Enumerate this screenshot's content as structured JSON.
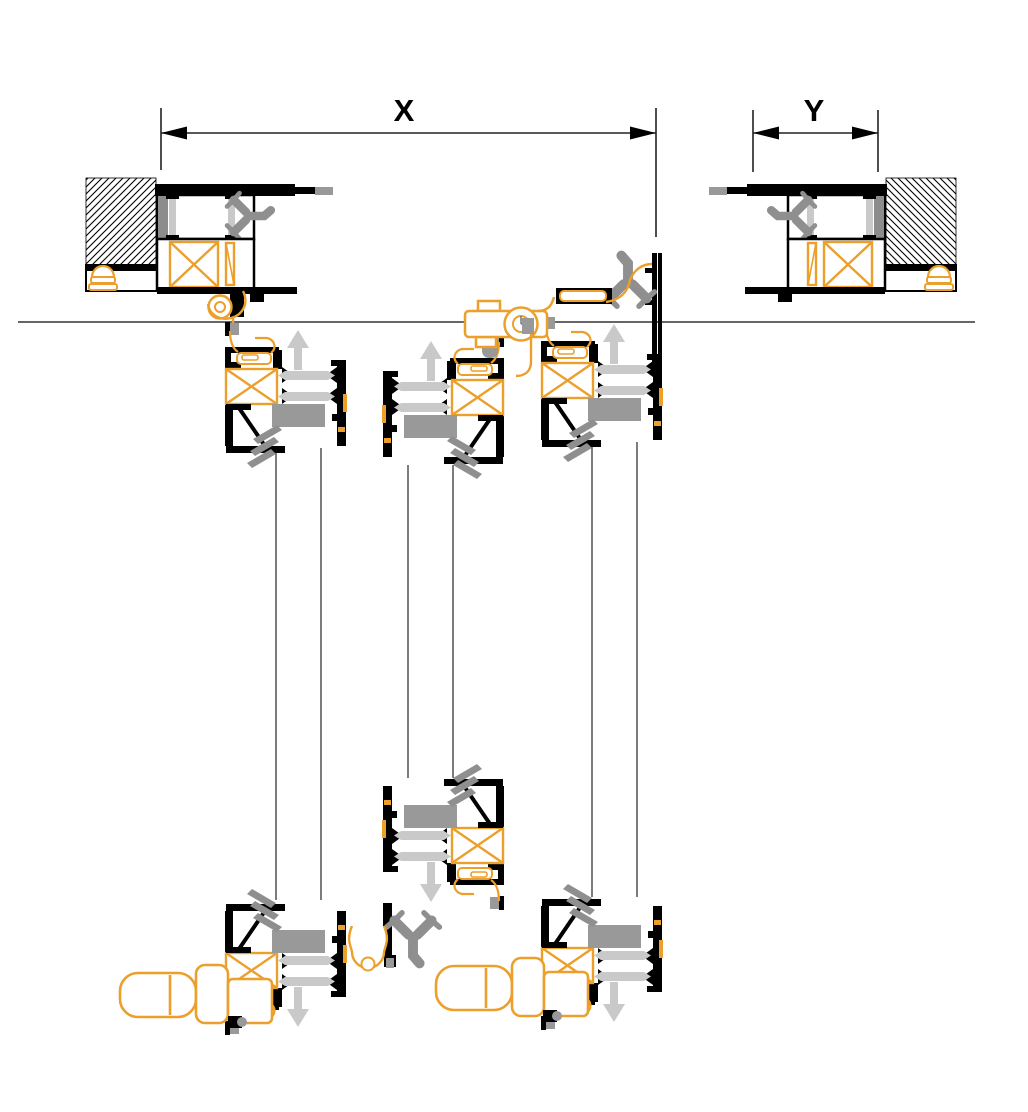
{
  "diagram": {
    "type": "window-door-profile-cross-section",
    "dimension_labels": {
      "x": "X",
      "y": "Y"
    },
    "colors": {
      "outline_black": "#000000",
      "hardware_orange": "#EC9F2B",
      "gasket_gray": "#8F8F8F",
      "glazing_block_gray": "#999999",
      "thermal_break_light_gray": "#C9C9C9",
      "dimension_line": "#222222",
      "background": "#FFFFFF"
    }
  }
}
